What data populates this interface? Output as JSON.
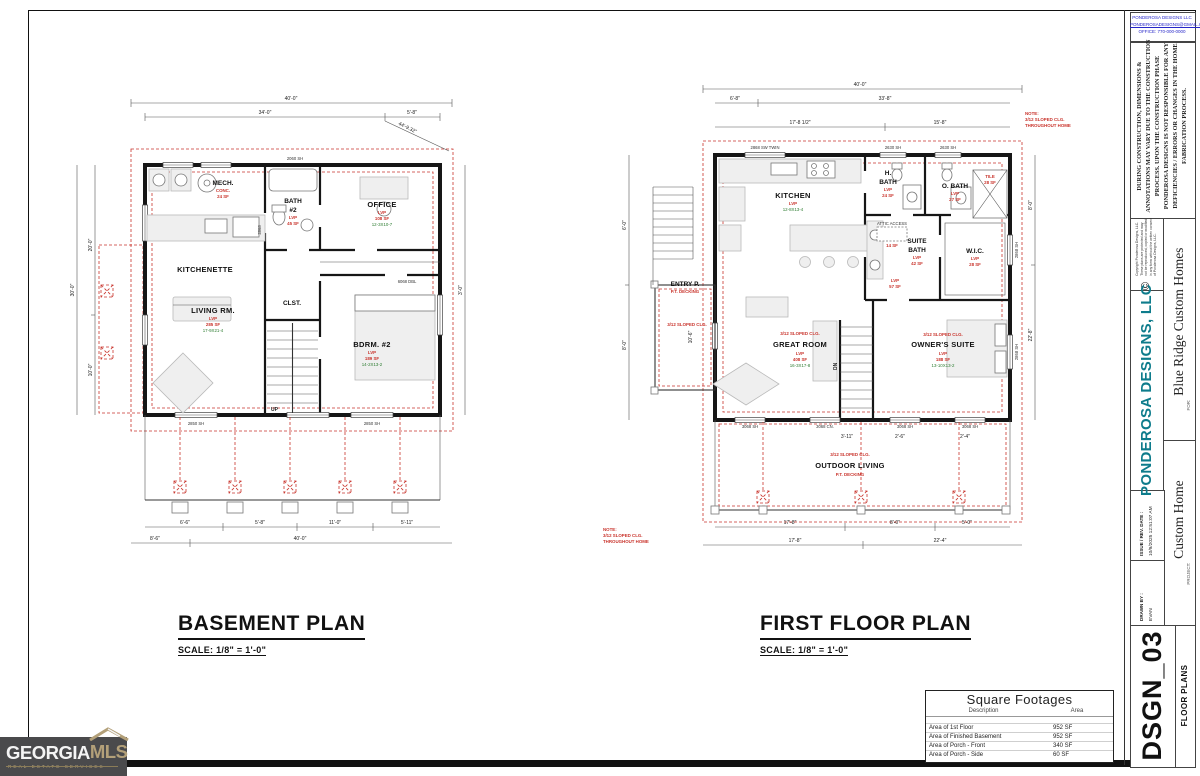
{
  "sheet": {
    "basement": {
      "title": "BASEMENT PLAN",
      "scale": "SCALE:  1/8\" = 1'-0\"",
      "rooms": {
        "mech": {
          "name": "MECH.",
          "finish": "CONC.",
          "area": "24 SF"
        },
        "bath2": {
          "n1": "BATH",
          "n2": "#2",
          "finish": "LVP",
          "area": "45 SF"
        },
        "office": {
          "name": "OFFICE",
          "finish": "LVP",
          "area": "108 SF",
          "size": "12-3X10-7"
        },
        "kitchenette": {
          "name": "KITCHENETTE"
        },
        "living": {
          "name": "LIVING RM.",
          "finish": "LVP",
          "area": "285 SF",
          "size": "17-9X21-4"
        },
        "clst": {
          "name": "CLST."
        },
        "bdrm2": {
          "name": "BDRM. #2",
          "finish": "LVP",
          "area": "189 SF",
          "size": "14-2X13-2"
        },
        "stair": "UP"
      },
      "dims": [
        "40'-0\"",
        "34'-0\"",
        "5'-8\"",
        "44'-9.32\"",
        "30'-0\"",
        "20'-0\"",
        "10'-0\"",
        "8'-6\"",
        "40'-0\"",
        "6'-6\"",
        "5'-8\"",
        "11'-0\"",
        "5'-11\"",
        "3'-0\""
      ],
      "windows": [
        "2850 SH",
        "2850 SH",
        "6068 DBL",
        "2868",
        "2060 SH"
      ]
    },
    "first_floor": {
      "title": "FIRST FLOOR PLAN",
      "scale": "SCALE:  1/8\" = 1'-0\"",
      "rooms": {
        "kitchen": {
          "name": "KITCHEN",
          "finish": "LVP",
          "size": "12-8X13-4"
        },
        "hbath": {
          "n1": "H.",
          "n2": "BATH",
          "finish": "LVP",
          "area": "24 SF"
        },
        "obath": {
          "name": "O. BATH",
          "finish": "LVP",
          "area": "27 SF"
        },
        "suitebath": {
          "n1": "SUITE",
          "n2": "BATH",
          "finish": "LVP",
          "area": "42 SF"
        },
        "wic": {
          "name": "W.I.C.",
          "finish": "LVP",
          "area": "28 SF"
        },
        "shower": {
          "finish": "TILE",
          "area": "28 SF"
        },
        "attic": {
          "name": "ATTIC ACCESS",
          "area": "14 SF"
        },
        "hall": {
          "finish": "LVP",
          "area": "57 SF"
        },
        "entry": {
          "name": "ENTRY P.",
          "finish": "P.T. DECKING"
        },
        "great": {
          "name": "GREAT ROOM",
          "finish": "LVP",
          "area": "408 SF",
          "size": "16-3X17-8"
        },
        "owner": {
          "name": "OWNER'S SUITE",
          "finish": "LVP",
          "area": "188 SF",
          "size": "13-10X13-2"
        },
        "outdoor": {
          "name": "OUTDOOR LIVING",
          "finish": "P.T. DECKING"
        },
        "stair": "DN"
      },
      "sloped": "3/12 SLOPED CLG.",
      "note": {
        "l1": "NOTE:",
        "l2": "3/12 SLOPED CLG.",
        "l3": "THROUGHOUT HOME"
      },
      "dims": [
        "40'-0\"",
        "6'-8\"",
        "33'-8\"",
        "17'-8 1/2\"",
        "15'-8\"",
        "6'-0\"",
        "8'-0\"",
        "8'-0\"",
        "22'-8\"",
        "2'-6\"",
        "2'-4\"",
        "3'-11\"",
        "17'-8\"",
        "8'-0\"",
        "5'-0\"",
        "17'-8\"",
        "22'-4\"",
        "10'-6\""
      ],
      "windows": [
        "2868 SW TWIN",
        "2630 SH",
        "2630 SH",
        "3068 SH",
        "3068 CN.",
        "3068 SH",
        "3068 SH",
        "2868 SH",
        "2868 SH"
      ]
    }
  },
  "title_block": {
    "contact": {
      "l1": "PONDEROSA DESIGNS LLC",
      "l2": "PONDEROSADESIGNS@GMAIL.COM",
      "l3": "OFFICE: 770-000-0000"
    },
    "disclaimer": "DURING CONSTRUCTION, DIMENSIONS & ANNOTATIONS MAY VARY DUE TO THE CONSTRUCTION PROCESS. UPON THE CONSTRUCTION PHASE PONDEROSA DESIGNS IS NOT RESPONSIBLE FOR ANY DEFICIENCIES / ERRORS OR CHANGES IN THE HOME FABRICATION PROCESS.",
    "copyright_symbol": "©",
    "copyright_text": "Copyright Ponderosa Designs, LLC. These plans are protected and may not be reproduced, copied or modified in any form without the written consent of Ponderosa Designs, LLC.",
    "company": "PONDEROSA DESIGNS, LLC",
    "for_label": "FOR:",
    "client": "Blue Ridge Custom Homes",
    "project_label": "PROJECT:",
    "project": "Custom Home",
    "issue_label": "ISSUE / REV. DATE :",
    "issue_value": "10/9/2025 12:51:07 AM",
    "drawn_label": "DRAWN BY :",
    "drawn_value": "EVAN",
    "sheet_number": "DSGN_03",
    "sheet_name": "FLOOR PLANS"
  },
  "sqft": {
    "title": "Square Footages",
    "col_desc": "Description",
    "col_area": "Area",
    "rows": [
      {
        "desc": "Area of 1st Floor",
        "area": "952 SF"
      },
      {
        "desc": "Area of Finished Basement",
        "area": "952 SF"
      },
      {
        "desc": "Area of Porch -  Front",
        "area": "340 SF"
      },
      {
        "desc": "Area of Porch -  Side",
        "area": "60 SF"
      }
    ]
  },
  "logo": {
    "word1": "GEORGIA",
    "word2": "MLS",
    "tagline": "REAL ESTATE SERVICES"
  }
}
